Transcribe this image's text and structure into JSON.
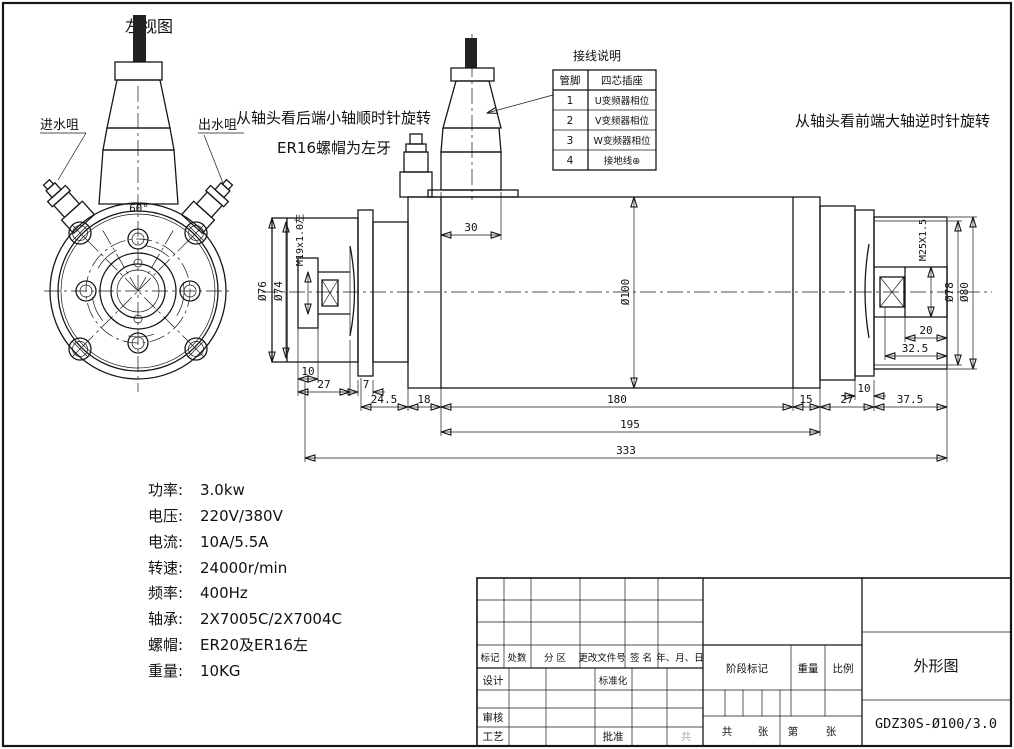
{
  "annotations": {
    "left_view_label": "左视图",
    "water_inlet": "进水咀",
    "water_outlet": "出水咀",
    "rear_rotation_note": "从轴头看后端小轴顺时针旋转",
    "rear_nut_note": "ER16螺帽为左牙",
    "front_rotation_note": "从轴头看前端大轴逆时针旋转",
    "flange_angle": "60°"
  },
  "wiring": {
    "title": "接线说明",
    "col_pin": "管脚",
    "col_socket": "四芯插座",
    "rows": [
      {
        "pin": "1",
        "desc": "U变频器相位"
      },
      {
        "pin": "2",
        "desc": "V变频器相位"
      },
      {
        "pin": "3",
        "desc": "W变频器相位"
      },
      {
        "pin": "4",
        "desc": "接地线⊕"
      }
    ]
  },
  "dims": {
    "d30": "30",
    "dia100": "Ø100",
    "dia76": "Ø76",
    "dia74": "Ø74",
    "m19": "M19x1.0左",
    "d10_rear": "10",
    "d27_rear": "27",
    "d7": "7",
    "d24_5": "24.5",
    "d18": "18",
    "d180": "180",
    "d15": "15",
    "d27_front": "27",
    "d37_5": "37.5",
    "d10_front": "10",
    "d195": "195",
    "d333": "333",
    "m25": "M25X1.5",
    "dia78": "Ø78",
    "dia80": "Ø80",
    "d20": "20",
    "d32_5": "32.5"
  },
  "specs": {
    "items": [
      {
        "label": "功率:",
        "value": "3.0kw"
      },
      {
        "label": "电压:",
        "value": "220V/380V"
      },
      {
        "label": "电流:",
        "value": "10A/5.5A"
      },
      {
        "label": "转速:",
        "value": "24000r/min"
      },
      {
        "label": "频率:",
        "value": "400Hz"
      },
      {
        "label": "轴承:",
        "value": "2X7005C/2X7004C"
      },
      {
        "label": "螺帽:",
        "value": "ER20及ER16左"
      },
      {
        "label": "重量:",
        "value": "10KG"
      }
    ]
  },
  "title_block": {
    "rev_headers": [
      "标记",
      "处数",
      "分 区",
      "更改文件号",
      "签 名",
      "年、月、日"
    ],
    "design": "设计",
    "standardization": "标准化",
    "check": "审核",
    "process": "工艺",
    "approve": "批准",
    "stage_mark": "阶段标记",
    "weight": "重量",
    "scale": "比例",
    "sheet_total_label": "共",
    "sheet_unit1": "张",
    "sheet_no_label": "第",
    "sheet_unit2": "张",
    "ghost_text": "共",
    "drawing_title": "外形图",
    "model": "GDZ30S-Ø100/3.0"
  }
}
